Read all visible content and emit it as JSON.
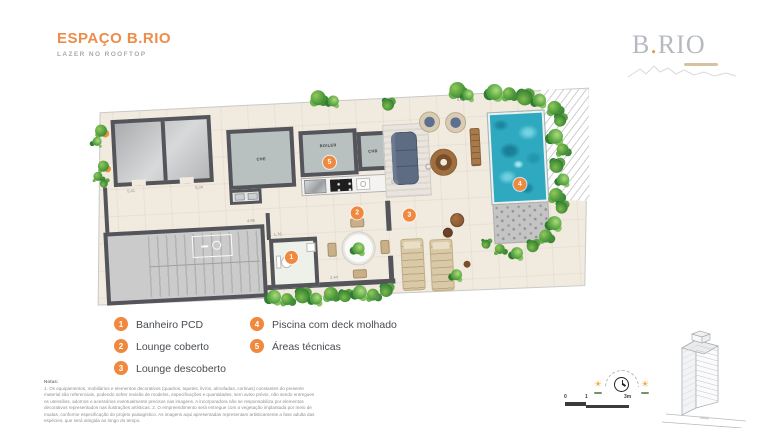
{
  "header": {
    "title": "ESPAÇO B.RIO",
    "subtitle": "LAZER NO ROOFTOP"
  },
  "logo": {
    "b": "B",
    "dot": ".",
    "rio": "RIO"
  },
  "plan": {
    "rooms": {
      "che": "CHE",
      "boiler": "BOILER",
      "chb": "CHB"
    },
    "badges": {
      "b1": "1",
      "b2": "2",
      "b3": "3",
      "b4": "4",
      "b5": "5"
    },
    "dimensions": [
      {
        "text": "5,41"
      },
      {
        "text": "5,34"
      },
      {
        "text": "4,96"
      },
      {
        "text": "1,76"
      },
      {
        "text": "2,44"
      },
      {
        "text": "4,62"
      },
      {
        "text": "5,36"
      },
      {
        "text": "5,45"
      }
    ]
  },
  "legend": {
    "items": [
      {
        "num": "1",
        "label": "Banheiro PCD"
      },
      {
        "num": "2",
        "label": "Lounge coberto"
      },
      {
        "num": "3",
        "label": "Lounge descoberto"
      },
      {
        "num": "4",
        "label": "Piscina com deck molhado"
      },
      {
        "num": "5",
        "label": "Áreas técnicas"
      }
    ]
  },
  "notes": {
    "title": "Notas:",
    "line1": "1. Os equipamentos, mobiliários e elementos decorativos (quadros, tapetes, livros, almofadas, cortinas) constantes do presente material são referenciais, podendo sofrer revisão de modelos, especificações e quantidades, sem aviso prévio, não sendo entregues os utensílios, adornos e acessórios eventualmente precisos nas imagens. A incorporadora não se responsabiliza por elementos decorativos representados nas ilustrações artísticas.",
    "line2": "2. O empreendimento será entregue com a vegetação implantada por meio de mudas, conforme especificação do projeto paisagístico. As imagens aqui apresentadas representam artisticamente a fase adulta das espécies, que será atingida ao longo do tempo."
  },
  "scale": {
    "t0": "0",
    "t1": "1",
    "t2": "3m"
  },
  "colors": {
    "accent": "#ee8c4a",
    "wall": "#54555b",
    "pool": "#2fa9bf",
    "plant": "#4f9c3d",
    "floor": "#f1eadf"
  }
}
